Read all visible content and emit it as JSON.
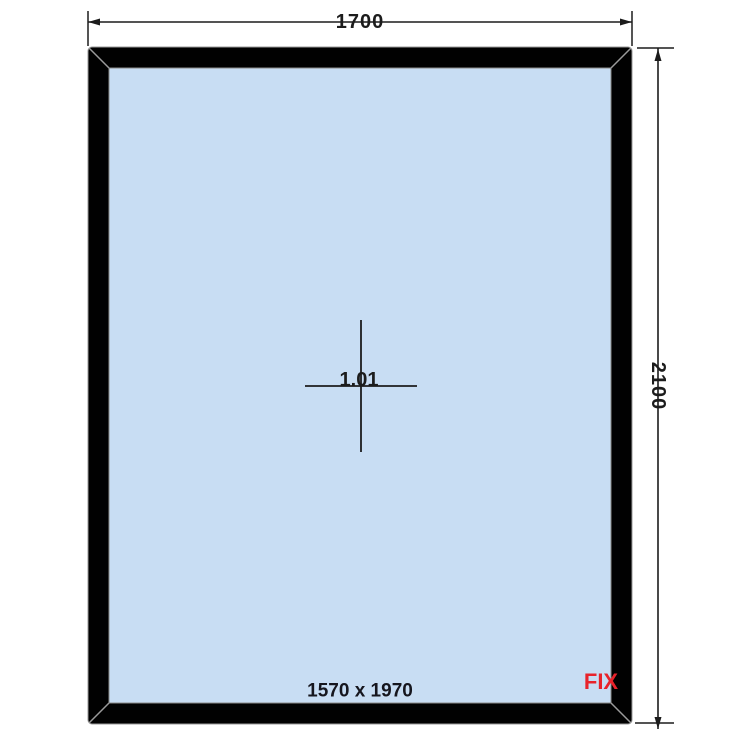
{
  "drawing": {
    "kind": "fixed-window-elevation",
    "frame_width_label": "1700",
    "frame_height_label": "2100",
    "position_label": "1.01",
    "glass_size_label": "1570 x 1970",
    "opening_type_label": "FIX",
    "colors": {
      "glass": "#c8ddf3",
      "frame": "#010101",
      "frame_outline": "#999999",
      "miter_line": "#9a9a9a",
      "dimension_line": "#1c1c1c",
      "fix_label": "#e8232b"
    }
  }
}
